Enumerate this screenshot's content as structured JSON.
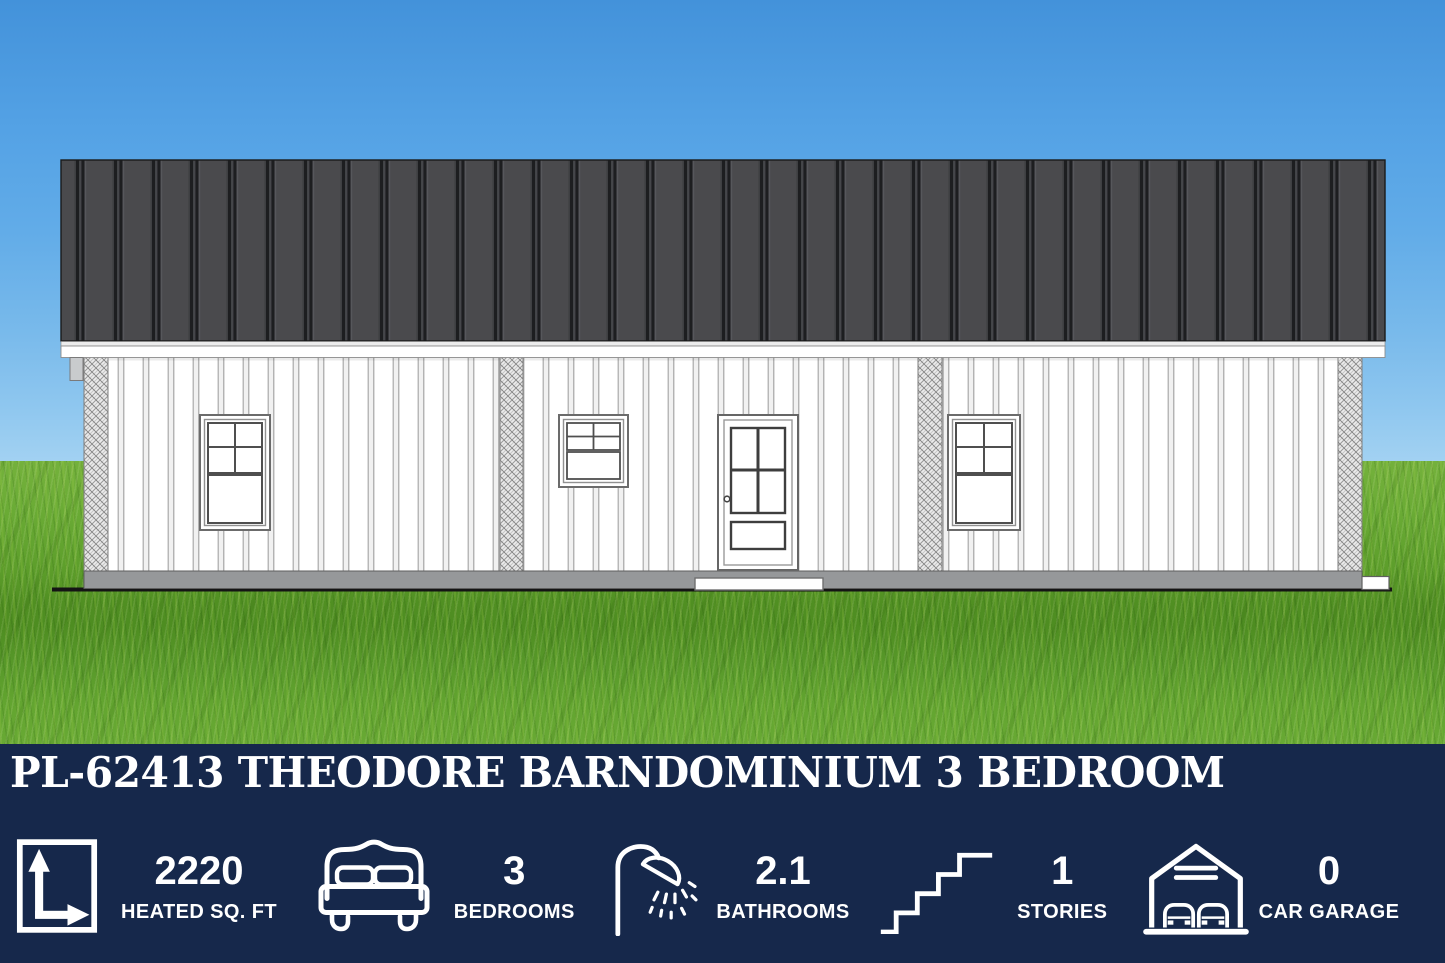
{
  "banner": {
    "background_color": "#16284B",
    "title": "PL-62413 THEODORE BARNDOMINIUM 3 BEDROOM",
    "stats": [
      {
        "icon": "dimensions-icon",
        "value": "2220",
        "label": "HEATED SQ. FT"
      },
      {
        "icon": "bed-icon",
        "value": "3",
        "label": "BEDROOMS"
      },
      {
        "icon": "shower-icon",
        "value": "2.1",
        "label": "BATHROOMS"
      },
      {
        "icon": "stairs-icon",
        "value": "1",
        "label": "STORIES"
      },
      {
        "icon": "garage-icon",
        "value": "0",
        "label": "CAR GARAGE"
      }
    ]
  },
  "scene": {
    "subject": "barndominium front elevation rendering",
    "sky_color": "#54A2E5",
    "grass_color": "#5F9E2C",
    "roof_color": "#4A4A4D",
    "roof_seam_color": "#1D1E20",
    "siding_color": "#FFFFFF",
    "trim_color": "#FFFFFF",
    "foundation_color": "#96989A",
    "window_count": 3,
    "door_count": 1
  }
}
